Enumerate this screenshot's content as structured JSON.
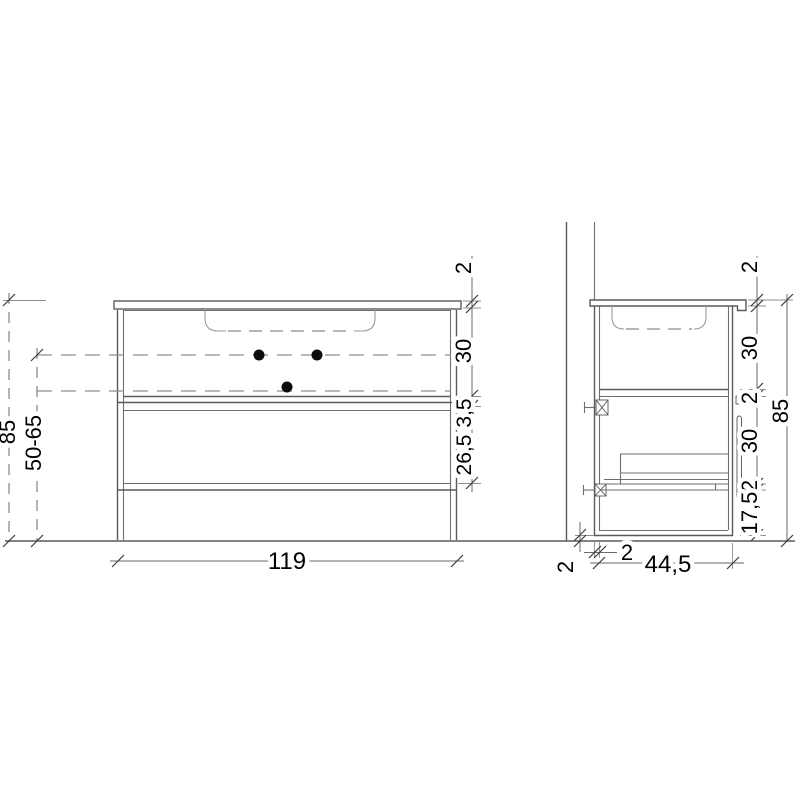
{
  "drawing": {
    "front_view": {
      "width": "119",
      "height": "85",
      "drain_height_range": "50-65",
      "countertop_thickness": "2",
      "top_drawer_height": "30",
      "rail_height": "3,5",
      "bottom_drawer_height": "26,5"
    },
    "side_view": {
      "depth": "44,5",
      "height": "85",
      "countertop_thickness": "2",
      "top_drawer_height": "30",
      "divider_thickness": "2",
      "bottom_drawer_height": "30",
      "bottom_panel_thickness": "2",
      "leg_height": "17,5",
      "wall_gap": "2",
      "floor_gap": "2"
    }
  }
}
